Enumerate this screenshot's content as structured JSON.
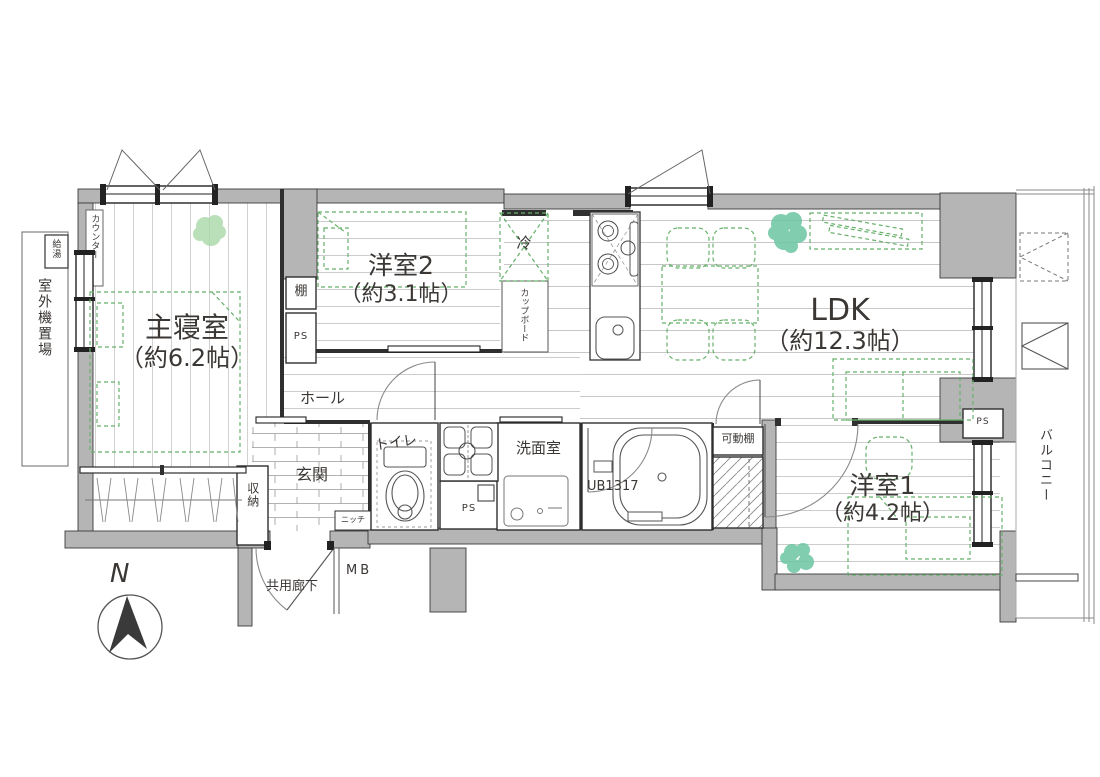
{
  "rooms": {
    "master_bedroom": {
      "name": "主寝室",
      "size": "（約6.2帖）"
    },
    "western_room2": {
      "name": "洋室2",
      "size": "（約3.1帖）"
    },
    "ldk": {
      "name": "LDK",
      "size": "（約12.3帖）"
    },
    "western_room1": {
      "name": "洋室1",
      "size": "（約4.2帖）"
    }
  },
  "labels": {
    "outdoor_unit_area": "室外機置場",
    "water_heater": "給湯",
    "counter": "カウンター",
    "shelf": "棚",
    "pipe_space": "PS",
    "hall": "ホール",
    "toilet": "トイレ",
    "entrance": "玄関",
    "storage": "収納",
    "niche": "ニッチ",
    "washroom": "洗面室",
    "unit_bath": "UB1317",
    "movable_shelf": "可動棚",
    "cupboard": "カップボード",
    "refrigerator": "冷",
    "balcony": "バルコニー",
    "common_corridor": "共用廊下",
    "meter_box": "MB",
    "north": "N"
  },
  "colors": {
    "wall": "#b5b5b5",
    "outline": "#3a3a3a",
    "furniture_green": "#66b06a",
    "plant_teal": "#6cc5a3",
    "plant_light_green": "#a8d9a8",
    "floor_line": "#cfcfcf",
    "text": "#3b3735"
  }
}
